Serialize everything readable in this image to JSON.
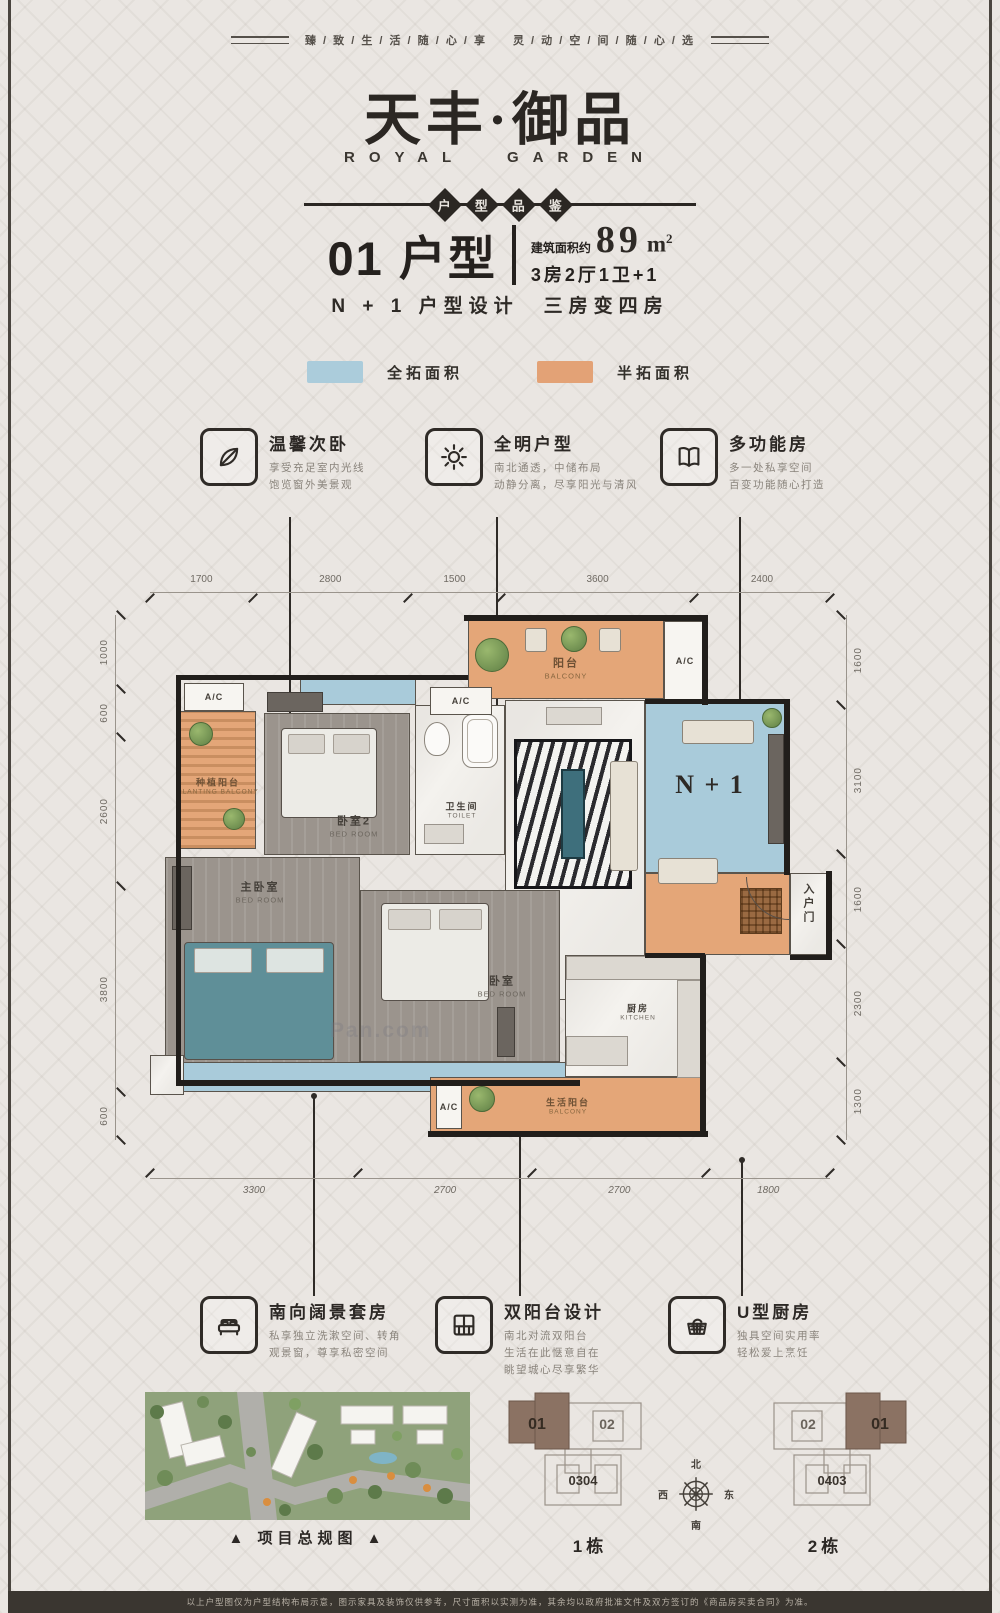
{
  "tagline": "臻 / 致 / 生 / 活 / 随 / 心 / 享　　灵 / 动 / 空 / 间 / 随 / 心 / 选",
  "brand": {
    "cn": "天丰·御品",
    "en": "ROYAL GARDEN"
  },
  "ribbon": [
    "户",
    "型",
    "品",
    "鉴"
  ],
  "unit": {
    "number_type": "01 户型",
    "area_prefix": "建筑面积约",
    "area_value": "89",
    "area_unit": "m",
    "area_exp": "2",
    "spec": "3房2厅1卫+1",
    "subtitle": "N + 1 户型设计　三房变四房"
  },
  "legend": {
    "full": {
      "label": "全拓面积",
      "color": "#abccdb"
    },
    "half": {
      "label": "半拓面积",
      "color": "#e3a276"
    }
  },
  "features_top": [
    {
      "icon": "leaf-icon",
      "title": "温馨次卧",
      "lines": [
        "享受充足室内光线",
        "饱览窗外美景观"
      ]
    },
    {
      "icon": "sun-icon",
      "title": "全明户型",
      "lines": [
        "南北通透，中储布局",
        "动静分离，尽享阳光与清风"
      ]
    },
    {
      "icon": "book-icon",
      "title": "多功能房",
      "lines": [
        "多一处私享空间",
        "百变功能随心打造"
      ]
    }
  ],
  "features_bottom": [
    {
      "icon": "bed-icon",
      "title": "南向阔景套房",
      "lines": [
        "私享独立洗漱空间、转角",
        "观景窗，尊享私密空间"
      ]
    },
    {
      "icon": "balcony-icon",
      "title": "双阳台设计",
      "lines": [
        "南北对流双阳台",
        "生活在此惬意自在",
        "眺望城心尽享繁华"
      ]
    },
    {
      "icon": "basket-icon",
      "title": "U型厨房",
      "lines": [
        "独具空间实用率",
        "轻松爱上烹饪"
      ]
    }
  ],
  "floorplan": {
    "dims_top": [
      "1700",
      "2800",
      "1500",
      "3600",
      "2400"
    ],
    "dims_left": [
      "1000",
      "600",
      "2600",
      "3800",
      "600"
    ],
    "dims_right": [
      "1600",
      "3100",
      "1600",
      "2300",
      "1300"
    ],
    "dims_bottom": [
      "3300",
      "2700",
      "2700",
      "1800"
    ],
    "ac_label": "A/C",
    "rooms": {
      "planting": {
        "cn": "种植阳台",
        "en": "PLANTING BALCONY"
      },
      "bedroom2": {
        "cn": "卧室2",
        "en": "BED ROOM"
      },
      "toilet": {
        "cn": "卫生间",
        "en": "TOILET"
      },
      "balcony": {
        "cn": "阳台",
        "en": "BALCONY"
      },
      "n1": {
        "label": "N + 1"
      },
      "master": {
        "cn": "主卧室",
        "en": "BED ROOM"
      },
      "bedroom": {
        "cn": "卧室",
        "en": "BED ROOM"
      },
      "kitchen": {
        "cn": "厨房",
        "en": "KITCHEN"
      },
      "life_balcony": {
        "cn": "生活阳台",
        "en": "BALCONY"
      },
      "entry": {
        "cn": "入户门"
      }
    },
    "watermark": "Pan.com"
  },
  "siteplan": {
    "caption": "▲ 项目总规图 ▲"
  },
  "keyplans": {
    "b1": {
      "highlight": "01",
      "other": "02",
      "bottom": "0304",
      "name": "1栋"
    },
    "b2": {
      "highlight": "01",
      "other": "02",
      "bottom": "0403",
      "name": "2栋"
    },
    "compass": {
      "n": "北",
      "e": "东",
      "s": "南",
      "w": "西"
    }
  },
  "disclaimer": "以上户型图仅为户型结构布局示意，图示家具及装饰仅供参考，尺寸面积以实测为准，其余均以政府批准文件及双方签订的《商品房买卖合同》为准。",
  "colors": {
    "full_area_blue": "#abccdb",
    "half_area_orange": "#e3a276",
    "wall_black": "#211e1b",
    "keyplan_brown": "#8b7263"
  }
}
